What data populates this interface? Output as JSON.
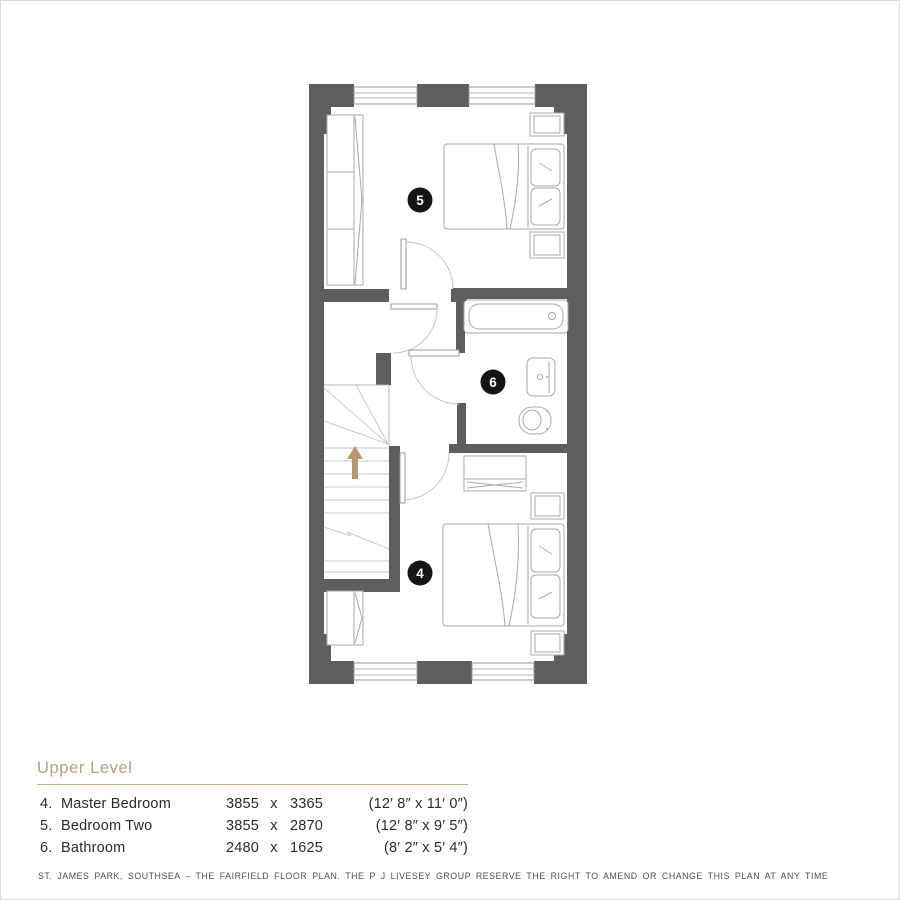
{
  "plan": {
    "room_labels": [
      {
        "id": "master-bedroom",
        "number": "4"
      },
      {
        "id": "bedroom-two",
        "number": "5"
      },
      {
        "id": "bathroom",
        "number": "6"
      }
    ],
    "stairs": {
      "direction": "up"
    }
  },
  "legend": {
    "title": "Upper Level",
    "rows": [
      {
        "num": "4.",
        "name": "Master Bedroom",
        "metric_w": "3855",
        "times": "x",
        "metric_h": "3365",
        "imperial": "(12′ 8″ x 11′ 0″)"
      },
      {
        "num": "5.",
        "name": "Bedroom Two",
        "metric_w": "3855",
        "times": "x",
        "metric_h": "2870",
        "imperial": "(12′ 8″ x 9′ 5″)"
      },
      {
        "num": "6.",
        "name": "Bathroom",
        "metric_w": "2480",
        "times": "x",
        "metric_h": "1625",
        "imperial": "(8′ 2″ x 5′ 4″)"
      }
    ]
  },
  "footer": {
    "disclaimer": "ST. JAMES PARK, SOUTHSEA – THE FAIRFIELD  FLOOR PLAN. THE P J LIVESEY GROUP RESERVE THE RIGHT TO AMEND OR CHANGE THIS PLAN AT ANY TIME"
  },
  "colors": {
    "wall": "#5f5e5e",
    "accent": "#b3a189",
    "stairs_arrow": "#b49a6a",
    "label_circle": "#151515",
    "line_light": "#b5b5b5"
  }
}
